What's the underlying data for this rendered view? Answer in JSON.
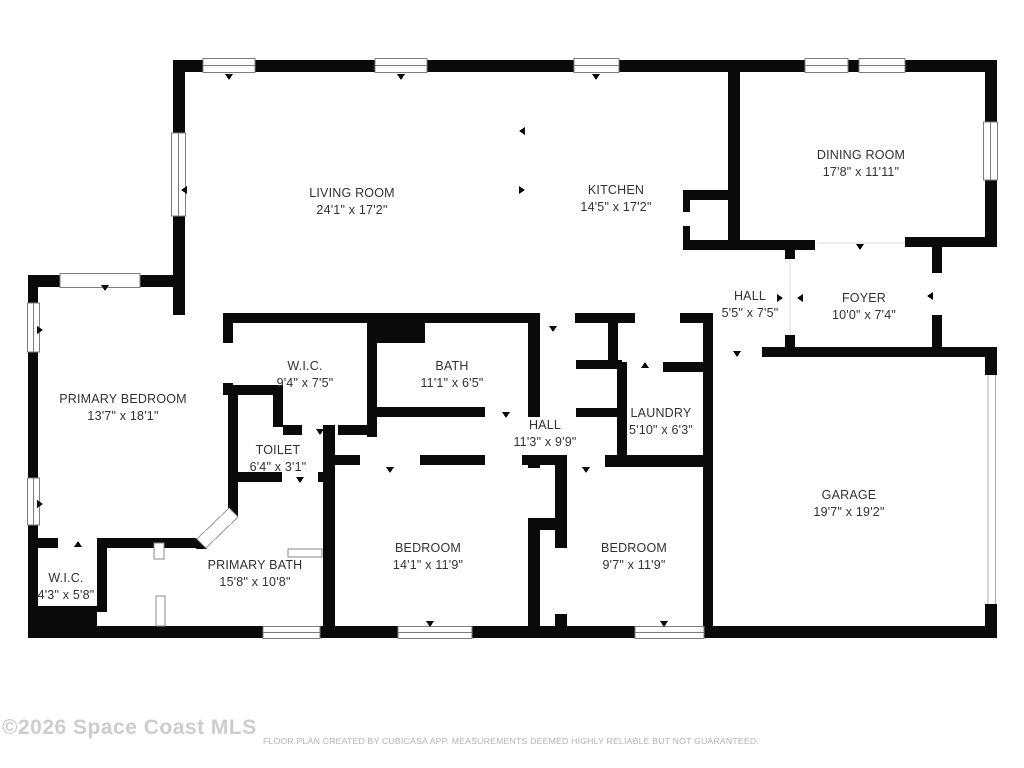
{
  "rooms": [
    {
      "name": "LIVING ROOM",
      "dims": "24'1\" x 17'2\""
    },
    {
      "name": "KITCHEN",
      "dims": "14'5\" x 17'2\""
    },
    {
      "name": "DINING ROOM",
      "dims": "17'8\" x 11'11\""
    },
    {
      "name": "HALL",
      "dims": "5'5\" x 7'5\""
    },
    {
      "name": "FOYER",
      "dims": "10'0\" x 7'4\""
    },
    {
      "name": "W.I.C.",
      "dims": "9'4\" x 7'5\""
    },
    {
      "name": "BATH",
      "dims": "11'1\" x 6'5\""
    },
    {
      "name": "PRIMARY BEDROOM",
      "dims": "13'7\" x 18'1\""
    },
    {
      "name": "TOILET",
      "dims": "6'4\" x 3'1\""
    },
    {
      "name": "HALL",
      "dims": "11'3\" x 9'9\""
    },
    {
      "name": "LAUNDRY",
      "dims": "5'10\" x 6'3\""
    },
    {
      "name": "GARAGE",
      "dims": "19'7\" x 19'2\""
    },
    {
      "name": "W.I.C.",
      "dims": "4'3\" x 5'8\""
    },
    {
      "name": "PRIMARY BATH",
      "dims": "15'8\" x 10'8\""
    },
    {
      "name": "BEDROOM",
      "dims": "14'1\" x 11'9\""
    },
    {
      "name": "BEDROOM",
      "dims": "9'7\" x 11'9\""
    }
  ],
  "footer": {
    "copyright": "©2026 Space Coast MLS",
    "disclaimer": "FLOOR PLAN CREATED BY CUBICASA APP. MEASUREMENTS DEEMED HIGHLY RELIABLE BUT NOT GUARANTEED."
  },
  "colors": {
    "wall": "#0a0a0a",
    "window_frame": "#7d7d7d",
    "label_text": "#313131"
  }
}
